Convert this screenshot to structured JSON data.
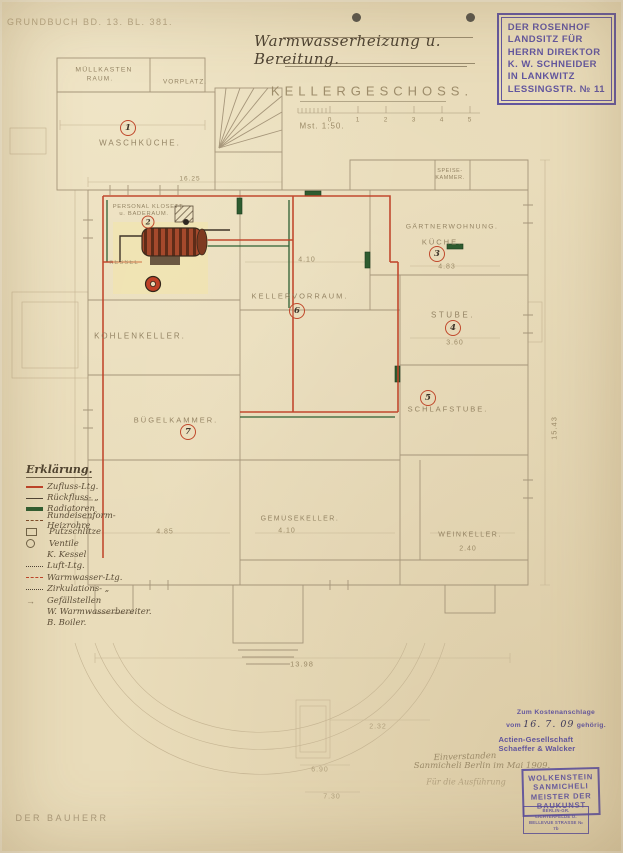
{
  "header": {
    "grundbuch": "GRUNDBUCH BD. 13. BL. 381.",
    "title": "Warmwasserheizung u. Bereitung."
  },
  "owner_stamp": {
    "lines": [
      "DER ROSENHOF",
      "LANDSITZ FÜR",
      "HERRN DIREKTOR",
      "K. W. SCHNEIDER",
      "IN LANKWITZ",
      "LESSINGSTR. № 11"
    ]
  },
  "plan": {
    "label": "KELLERGESCHOSS.",
    "scale_note": "Mst. 1:50.",
    "scale_ticks": [
      "0",
      "1",
      "2",
      "3",
      "4",
      "5"
    ]
  },
  "rooms": {
    "muellkasten": {
      "l1": "MÜLLKASTEN",
      "l2": "RAUM."
    },
    "vorplatz": {
      "label": "VORPLATZ."
    },
    "waschkueche": {
      "label": "WASCHKÜCHE.",
      "no": "1"
    },
    "klosett": {
      "l1": "PERSONAL KLOSETT",
      "l2": "u. BADERAUM.",
      "no": "2"
    },
    "kesselraum": {
      "label": "KESSEL"
    },
    "speisekammer": {
      "l1": "SPEISE-",
      "l2": "KAMMER."
    },
    "kellervorraum": {
      "label": "KELLERVORRAUM.",
      "no": "6",
      "dim": "4.10"
    },
    "gaertnerwohnung": {
      "label": "GÄRTNERWOHNUNG."
    },
    "kueche": {
      "label": "KÜCHE.",
      "no": "3",
      "dim": "4.83"
    },
    "stube": {
      "label": "STUBE.",
      "no": "4",
      "dim": "3.60"
    },
    "schlafstube": {
      "label": "SCHLAFSTUBE.",
      "no": "5"
    },
    "kohlenkeller": {
      "label": "KOHLENKELLER."
    },
    "buegelkammer": {
      "label": "BÜGELKAMMER.",
      "no": "7"
    },
    "gemuesekeller": {
      "label": "GEMÜSEKELLER.",
      "dim": "4.10"
    },
    "weinkeller": {
      "label": "WEINKELLER.",
      "dim": "2.40"
    }
  },
  "dimensions": {
    "top": "16.25",
    "left_cellar": "4.85",
    "bottom": "13.98",
    "right": "15.43",
    "d1": "2.32",
    "d2": "6.90",
    "d3": "7.30"
  },
  "legend": {
    "title": "Erklärung.",
    "items": [
      "Zufluss-Ltg.",
      "Rückfluss- „",
      "Radiatoren",
      "Rundeisenform-Heizrohre",
      "Putzschlitze",
      "Ventile",
      "K. Kessel",
      "Luft-Ltg.",
      "Warmwasser-Ltg.",
      "Zirkulations- „",
      "Gefällstellen",
      "W. Warmwasserbereiter.",
      "B. Boiler."
    ]
  },
  "footer": {
    "bauherr": "DER BAUHERR",
    "cost_stamp": {
      "l1": "Zum Kostenanschlage",
      "prefix": "vom",
      "date": "16. 7. 09",
      "suffix": "gehörig."
    },
    "company_stamp": "Actien-Gesellschaft Schaeffer & Walcker",
    "approval": {
      "l1": "Einverstanden",
      "l2": "Sanmicheli  Berlin im Mai 1909.",
      "l3": "Für die Ausführung"
    },
    "architect_stamp": {
      "lines": [
        "WOLKENSTEIN",
        "SANMICHELI",
        "MEISTER DER",
        "BAUKUNST"
      ]
    },
    "address_stamp": {
      "l1": "BERLIN-GR. LICHTERFELDE O.",
      "l2": "BELLEVUE STRASSE № 7b"
    }
  },
  "colors": {
    "paper": "#e9dcba",
    "pipe_red": "#bf4127",
    "pipe_green": "#2f5f33",
    "stamp_purple": "#574b9d",
    "pencil": "#8b7a5a"
  }
}
